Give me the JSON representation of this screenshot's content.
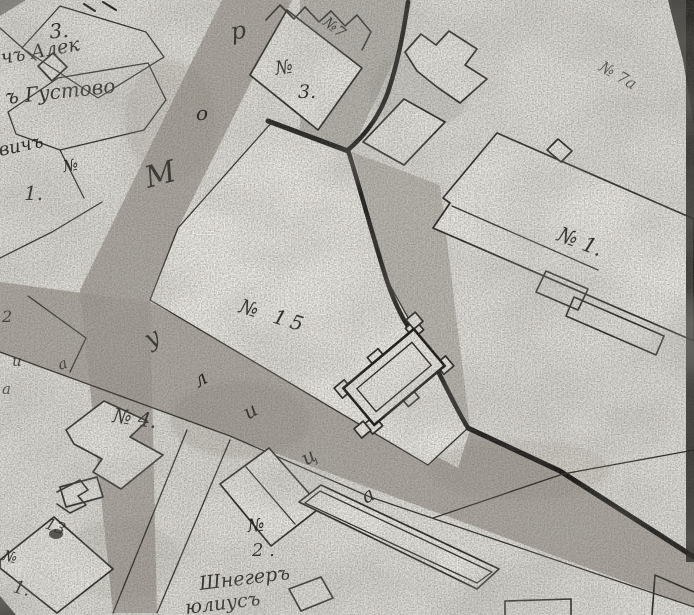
{
  "colors": {
    "paper": "#e6e4df",
    "plot": "#efede8",
    "street_shade": "#a29e96",
    "ink": "#1d1b18",
    "heavy_boundary": "#141311",
    "scan_edge": "#201f1b"
  },
  "labels": {
    "tl_house3": "3.",
    "tl_owner1": "чъ Алек",
    "tl_owner2": "ъ Густово",
    "tl_owner3": "вичъ",
    "tl_no": "№",
    "tl_one": "1.",
    "c3_no": "№",
    "c3_num": "3.",
    "no7": "№7",
    "no7a": "№ 7а",
    "r1_label": "№ 1.",
    "plot15": "№ 15",
    "no4": "№ 4.",
    "b2_no": "№",
    "b2_num": "2 .",
    "owner_b1": "Шнегеръ",
    "owner_b2": "юлиусъ",
    "bl_no": "№",
    "bl_one": "1.",
    "bl_smudge": "13",
    "frag_2": "2",
    "frag_i": "и",
    "frag_a1": "а",
    "frag_a2": "а"
  },
  "street_letters": {
    "up_street": {
      "m": "М",
      "o": "о",
      "r": "р"
    },
    "diag_street": {
      "u": "у",
      "l": "л",
      "i": "и",
      "c": "ц",
      "a": "а"
    }
  }
}
